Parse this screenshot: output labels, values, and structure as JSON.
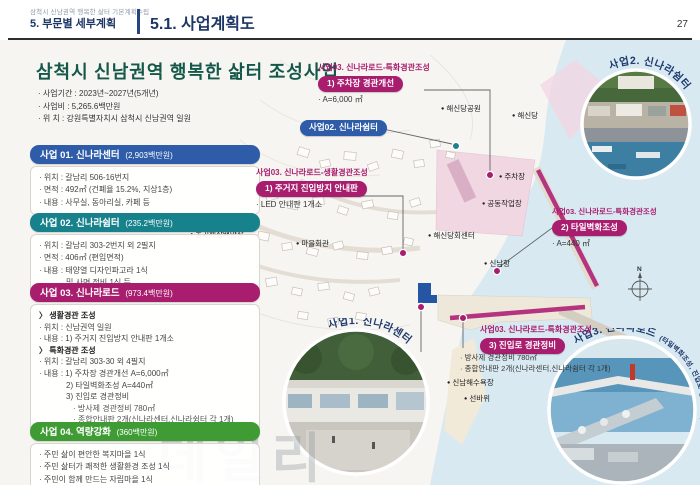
{
  "header": {
    "project_line": "삼척시 신남권역 행복한 삶터 기본계획수립",
    "section": "5. 부문별 세부계획",
    "title": "5.1. 사업계획도",
    "page": "27"
  },
  "overview": {
    "title": "삼척시 신남권역 행복한 삶터 조성사업",
    "items": [
      "· 사업기간 : 2023년~2027년(5개년)",
      "· 사업비 : 5,265.6백만원",
      "· 위    치 : 강원특별자치시 삼척시 신남권역 일원"
    ]
  },
  "projects": [
    {
      "title": "사업 01. 신나라센터",
      "budget": "(2,903백만원)",
      "rows": [
        "· 위치 : 갈남리 506-16번지",
        "· 면적 : 492㎡ (건폐율 15.2%, 지상1층)",
        "· 내용 : 사무실, 동아리실, 카페 등"
      ]
    },
    {
      "title": "사업 02. 신나라쉼터",
      "budget": "(235.2백만원)",
      "rows": [
        "· 위치 : 갈남리 303-2번지 외 2필지",
        "· 면적 : 406㎡ (편입면적)",
        "· 내용 : 태양열 디자인파고라 1식",
        "및 사면 정비 1식 등"
      ]
    },
    {
      "title": "사업 03. 신나라로드",
      "budget": "(973.4백만원)",
      "rows": [
        "〉 생활경관 조성",
        "· 위치 : 신남권역 일원",
        "· 내용 : 1) 주거지 진입방지 안내판 1개소",
        "〉 특화경관 조성",
        "· 위치 : 갈남리 303-30 외 4필지",
        "· 내용 : 1) 주차장 경관개선 A=6,000㎡",
        "2) 타일벽화조성 A=440㎡",
        "3) 진입로 경관정비",
        "· 방사제 경관정비 780㎡",
        "· 종합안내판 2개(신나라센터,신나라쉼터 각 1개)"
      ]
    },
    {
      "title": "사업 04. 역량강화",
      "budget": "(360백만원)",
      "rows": [
        "· 주민 삶이 편안한 복지마을 1식",
        "· 주민 삶터가 쾌적한 생활환경 조성 1식",
        "· 주민이 함께 만드는 자립마을 1식"
      ]
    }
  ],
  "callouts": [
    {
      "category": "사업03. 신나라로드-특화경관조성",
      "pill": "1) 주차장 경관개선",
      "d1": "· A=6,000 ㎡"
    },
    {
      "pill": "사업02. 신나라쉼터"
    },
    {
      "category": "사업03. 신나라로드-생활경관조성",
      "pill": "1) 주거지 진입방지 안내판",
      "d1": "· LED 안내판 1개소"
    },
    {
      "category": "사업03. 신나라로드-특화경관조성",
      "pill": "2) 타일벽화조성",
      "d1": "· A=440 ㎡"
    },
    {
      "category": "사업03. 신나라로드-특화경관조성",
      "pill": "3) 진입로 경관정비",
      "d1": "· 방사제 경관정비 780㎡",
      "d2": "· 종합안내판 2개(신나라센터,신나라쉼터 각 1개)"
    }
  ],
  "map_labels": [
    "해신당공원",
    "해신당",
    "주차장",
    "공동작업장",
    "해신당회센터",
    "신남항",
    "마을회관",
    "돌기해삼배양장",
    "신남해수욕장",
    "선바위"
  ],
  "insets": [
    {
      "label": "사업2. 신나라쉼터"
    },
    {
      "label": "사업1. 신나라센터"
    },
    {
      "label": "사업3. 신나라로드",
      "label_sub": "(타일벽화조성, 진입로 경관정비)"
    }
  ],
  "compass": "N",
  "watermark": "데일리",
  "colors": {
    "navy": "#1d3666",
    "blue": "#2e5ca8",
    "teal": "#17828c",
    "magenta": "#a81d6e",
    "green": "#3f9c35",
    "title_green": "#14584a",
    "sea": "#d8e9f2",
    "pink_zone": "#f1d7e2"
  }
}
